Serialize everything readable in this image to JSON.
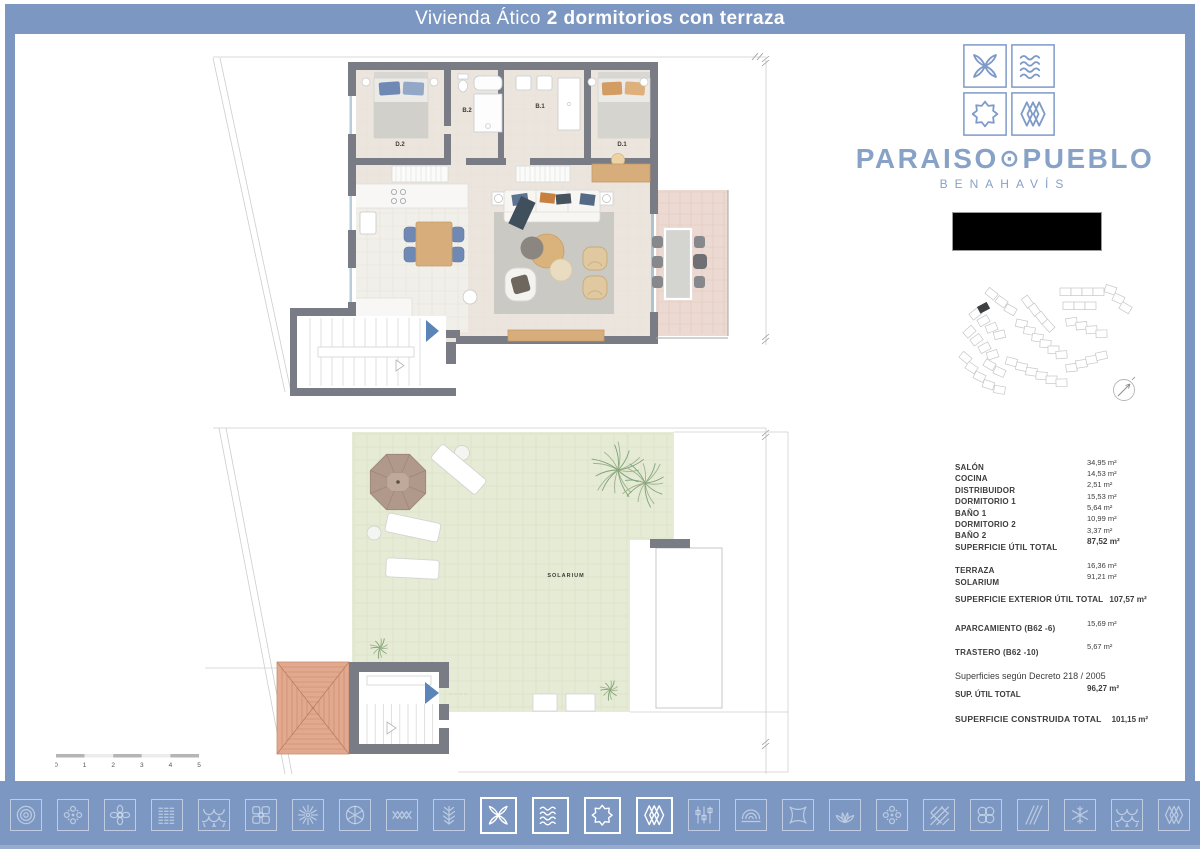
{
  "header": {
    "title_light": "Vivienda Ático",
    "title_bold": "2 dormitorios con terraza"
  },
  "brand": {
    "word_left": "PARAISO",
    "separator": "⊙",
    "word_right": "PUEBLO",
    "subtitle": "BENAHAVÍS",
    "tiles": [
      "petal-cross",
      "waves",
      "eight-point-star",
      "diamond-lattice"
    ],
    "color": "#7e9ac8"
  },
  "plans": {
    "upper": {
      "labels": {
        "d2": "D.2",
        "b2": "B.2",
        "b1": "B.1",
        "d1": "D.1"
      }
    },
    "lower": {
      "labels": {
        "solarium": "SOLARIUM"
      }
    }
  },
  "scale_bar": {
    "ticks": [
      "0",
      "1",
      "2",
      "3",
      "4",
      "5"
    ]
  },
  "areas": {
    "rows": [
      {
        "label": "SALÓN",
        "value": "34,95 m²"
      },
      {
        "label": "COCINA",
        "value": "14,53 m²"
      },
      {
        "label": "DISTRIBUIDOR",
        "value": "2,51 m²"
      },
      {
        "label": "DORMITORIO 1",
        "value": "15,53 m²"
      },
      {
        "label": "BAÑO 1",
        "value": "5,64 m²"
      },
      {
        "label": "DORMITORIO 2",
        "value": "10,99 m²"
      },
      {
        "label": "BAÑO 2",
        "value": "3,37 m²"
      },
      {
        "label": "SUPERFICIE ÚTIL TOTAL",
        "value": "87,52 m²",
        "bold": true
      },
      {
        "label": "TERRAZA",
        "value": "16,36 m²",
        "gap": true
      },
      {
        "label": "SOLARIUM",
        "value": "91,21 m²"
      },
      {
        "label": "SUPERFICIE EXTERIOR ÚTIL  TOTAL",
        "value": "107,57 m²",
        "bold": true,
        "gap": true,
        "inline": true
      },
      {
        "label": "APARCAMIENTO (B62 -6)",
        "value": "15,69 m²",
        "gap": true
      },
      {
        "label": "TRASTERO (B62 -10)",
        "value": "5,67 m²",
        "gap": true
      }
    ]
  },
  "decree": {
    "note": "Superficies según Decreto 218 / 2005",
    "sup_util_label": "SUP. ÚTIL TOTAL",
    "sup_util_value": "96,27 m²",
    "construida_label": "SUPERFICIE CONSTRUIDA TOTAL",
    "construida_value": "101,15 m²"
  },
  "footer": {
    "icons": [
      {
        "name": "concentric-circles",
        "highlighted": false
      },
      {
        "name": "dot-flower",
        "highlighted": false
      },
      {
        "name": "petal-knot",
        "highlighted": false
      },
      {
        "name": "dashed-lines",
        "highlighted": false
      },
      {
        "name": "fish-scales",
        "highlighted": false
      },
      {
        "name": "square-cluster",
        "highlighted": false
      },
      {
        "name": "ray-flower",
        "highlighted": false
      },
      {
        "name": "circle-flower",
        "highlighted": false
      },
      {
        "name": "zigzag",
        "highlighted": false
      },
      {
        "name": "fern",
        "highlighted": false
      },
      {
        "name": "petal-cross",
        "highlighted": true
      },
      {
        "name": "waves",
        "highlighted": true
      },
      {
        "name": "eight-point-star",
        "highlighted": true
      },
      {
        "name": "diamond-lattice",
        "highlighted": true
      },
      {
        "name": "sliders",
        "highlighted": false
      },
      {
        "name": "concentric-arcs",
        "highlighted": false
      },
      {
        "name": "crossed-knots",
        "highlighted": false
      },
      {
        "name": "lotus",
        "highlighted": false
      },
      {
        "name": "dot-flower",
        "highlighted": false
      },
      {
        "name": "diagonal-crosshatch",
        "highlighted": false
      },
      {
        "name": "double-circles",
        "highlighted": false
      },
      {
        "name": "diagonal-lines",
        "highlighted": false
      },
      {
        "name": "snowflake",
        "highlighted": false
      },
      {
        "name": "fish-scales",
        "highlighted": false
      },
      {
        "name": "diamond-lattice",
        "highlighted": false
      }
    ]
  },
  "colors": {
    "frame": "#7c97c1",
    "wall": "#797b85",
    "floor": "#ebe5dd",
    "terrace": "#ecd9d1",
    "solarium": "#e5ebd4",
    "roof": "#e3a98e",
    "arrow": "#5b84b8",
    "logo": "#7e9ac8",
    "black_box": "#000000"
  }
}
